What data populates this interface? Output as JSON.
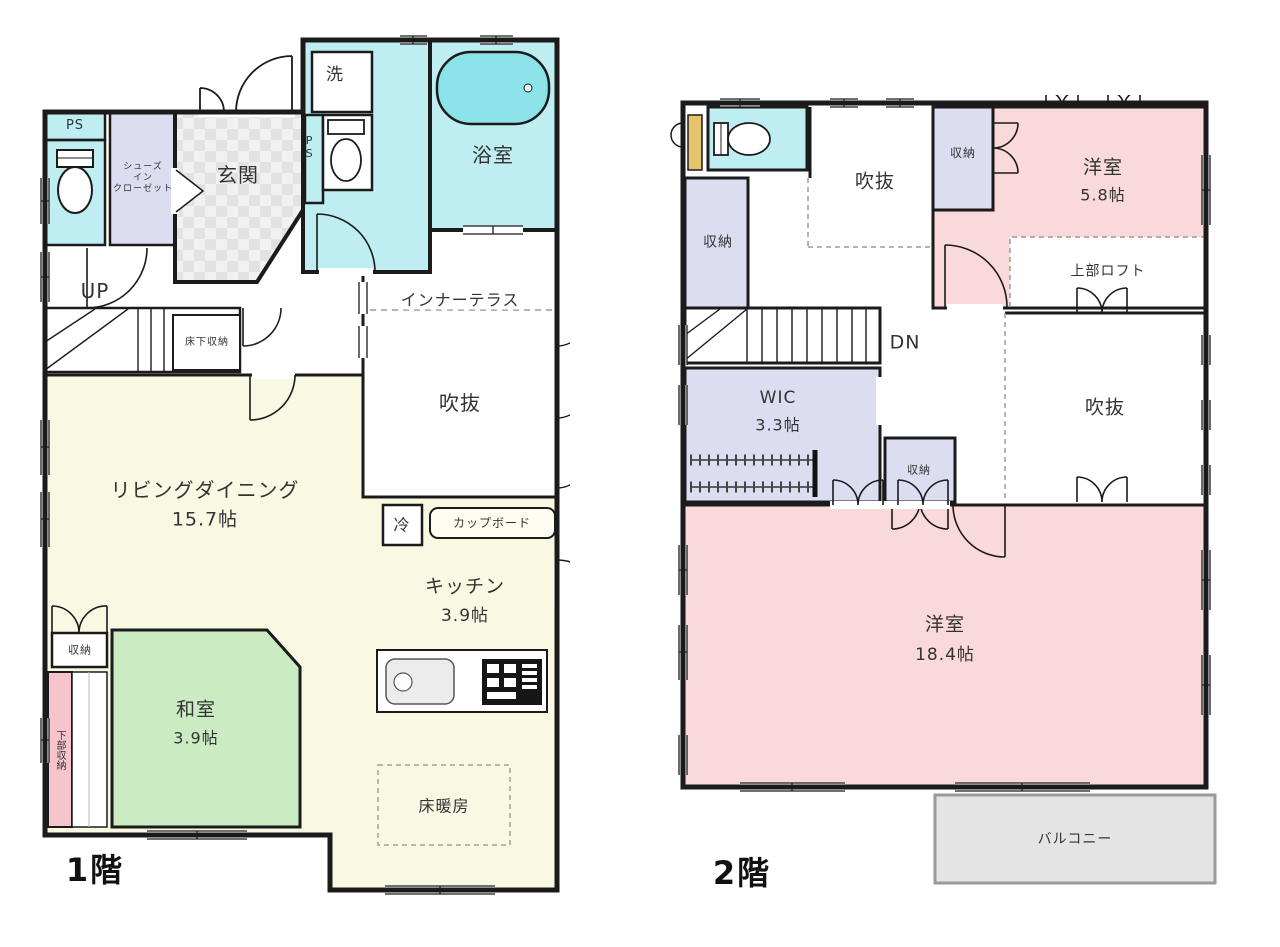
{
  "document": {
    "type": "madori-floorplan",
    "floors_shown": 2
  },
  "colors": {
    "wall": "#1b1b1b",
    "water_room": "#bfeef2",
    "bathtub": "#8ce2e9",
    "closet_lavender": "#dcddf0",
    "entrance_tile": "#ececec",
    "ldk_cream": "#f9f8e2",
    "tatami_green": "#cbebc2",
    "bedroom_pink": "#f9d9d9",
    "lower_storage_pink": "#f6c4ca",
    "balcony_gray": "#e4e4e4",
    "cabinet_yellow": "#e6c46d",
    "dashed_line": "#9b9b9b"
  },
  "floor1": {
    "title": "1階",
    "labels": {
      "ps_top": "PS",
      "shoes_line1": "シューズ",
      "shoes_line2": "イン",
      "shoes_line3": "クローゼット",
      "genkan": "玄関",
      "laundry": "洗",
      "ps_side": "PS",
      "bath": "浴室",
      "inner_terrace": "インナーテラス",
      "void": "吹抜",
      "up": "UP",
      "underfloor_storage": "床下収納",
      "living": "リビングダイニング",
      "living_size": "15.7帖",
      "fridge": "冷",
      "cupboard": "カップボード",
      "kitchen": "キッチン",
      "kitchen_size": "3.9帖",
      "closet": "収納",
      "lower_storage": "下部収納",
      "washitsu": "和室",
      "washitsu_size": "3.9帖",
      "floor_heating": "床暖房"
    }
  },
  "floor2": {
    "title": "2階",
    "labels": {
      "closet_left": "収納",
      "void_top": "吹抜",
      "closet_top": "収納",
      "bedroom_small": "洋室",
      "bedroom_small_size": "5.8帖",
      "loft": "上部ロフト",
      "dn": "DN",
      "wic": "WIC",
      "wic_size": "3.3帖",
      "closet_mid": "収納",
      "void_right": "吹抜",
      "bedroom_large": "洋室",
      "bedroom_large_size": "18.4帖",
      "balcony": "バルコニー"
    }
  }
}
